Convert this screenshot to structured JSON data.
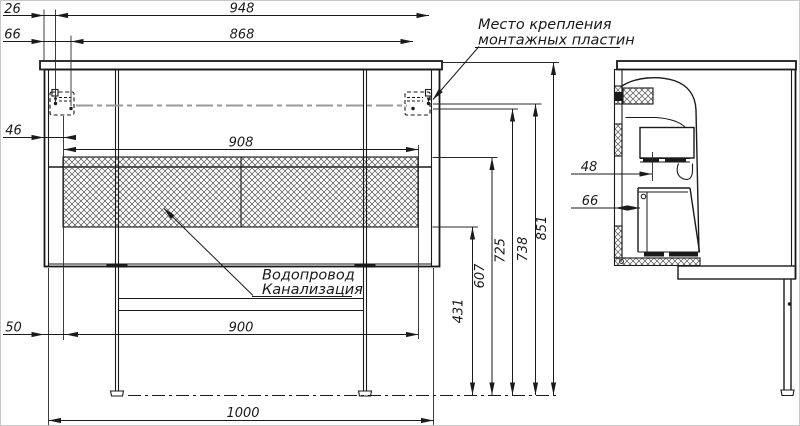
{
  "dims": {
    "d26": "26",
    "d66_left": "66",
    "d46": "46",
    "d50": "50",
    "d948": "948",
    "d868": "868",
    "d908": "908",
    "d900": "900",
    "d1000": "1000",
    "d431": "431",
    "d607": "607",
    "d725": "725",
    "d738": "738",
    "d851": "851",
    "d48_side": "48",
    "d66_side": "66"
  },
  "labels": {
    "mounting_line1": "Место крепления",
    "mounting_line2": "монтажных пластин",
    "plumbing_line1": "Водопровод",
    "plumbing_line2": "Канализация"
  },
  "colors": {
    "line": "#1a1a1a",
    "centerline": "#9a9a9a",
    "background": "#ffffff"
  }
}
